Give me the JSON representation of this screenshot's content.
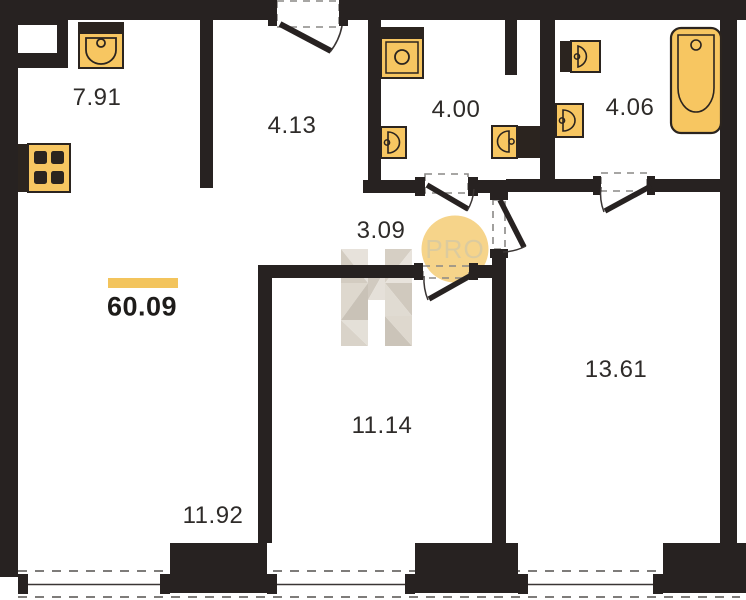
{
  "plan": {
    "total_area": "60.09",
    "rooms": [
      {
        "name": "kitchen",
        "area": "7.91"
      },
      {
        "name": "hallway",
        "area": "4.13"
      },
      {
        "name": "bathroom-left",
        "area": "4.00"
      },
      {
        "name": "bathroom-right",
        "area": "4.06"
      },
      {
        "name": "corridor",
        "area": "3.09"
      },
      {
        "name": "room-middle",
        "area": "11.14"
      },
      {
        "name": "room-right",
        "area": "13.61"
      },
      {
        "name": "room-left",
        "area": "11.92"
      }
    ],
    "watermark": {
      "badge": "PRO",
      "logo_letter": "H"
    },
    "icons": [
      "kitchen-sink-icon",
      "stove-icon",
      "washing-machine-icon",
      "toilet-icon",
      "sink-icon",
      "bathtub-icon",
      "door-swing-icon",
      "window-icon"
    ],
    "colors": {
      "wall": "#272221",
      "fixture_fill": "#f7c661",
      "fixture_stroke": "#2b241f",
      "accent_bar": "#f3c45c",
      "badge_bg": "#f6d48a",
      "badge_text": "#dccb9e",
      "watermark_light": "#e7e2da",
      "watermark_dark": "#c8c1b5",
      "dash": "#7e7c7a"
    }
  }
}
